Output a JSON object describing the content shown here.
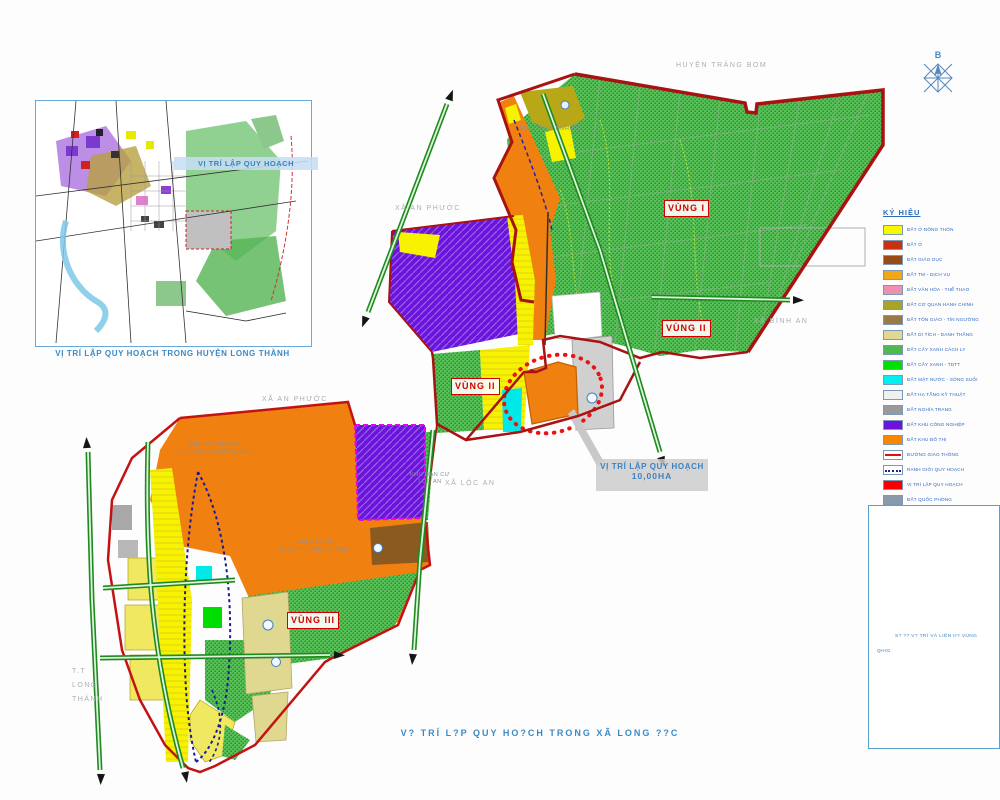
{
  "inset": {
    "title": "VỊ TRÍ LẬP QUY HOẠCH",
    "caption": "VỊ TRÍ LẬP QUY HOẠCH TRONG HUYỆN LONG THÀNH"
  },
  "map": {
    "region_labels": {
      "huyen_trang_bom": "HUYỆN TRẢNG BOM",
      "xa_an_phuoc_top": "XÃ AN PHƯỚC",
      "xa_binh_an": "XÃ BÌNH AN",
      "xa_loc_an": "XÃ LỘC AN",
      "xa_an_phuoc_mid": "XÃ AN PHƯỚC",
      "tt_line1": "T.T",
      "tt_line2": "LONG",
      "tt_line3": "THÀNH"
    },
    "zone_labels": {
      "vung1": "VÙNG I",
      "vung2_east": "VÙNG II",
      "vung2_west": "VÙNG II",
      "vung3": "VÙNG III"
    },
    "site_callout": {
      "line1": "VỊ TRÍ LẬP QUY HOẠCH",
      "line2": "10,00HA"
    },
    "area_texts": {
      "khu_cong_nghiep": "KHU CÔNG NGHIỆP",
      "khu_do_thi_1": "KHU ĐÔ THỊ MỚI",
      "khu_do_thi_2": "(CTY CAO SU ĐỒNG NAI)",
      "kdc_loc_an_1": "KHU DÂN CƯ",
      "kdc_loc_an_2": "LỘC AN",
      "kdc_2_1": "KHU DÂN CƯ",
      "kdc_2_2": "(CTY CP LONG THÀNH)"
    },
    "bottom_caption": "V? TRÍ L?P QUY HO?CH TRONG XÃ LONG ??C",
    "north_label": "B"
  },
  "legend": {
    "header": "KÝ HIỆU",
    "items": [
      {
        "label": "ĐẤT Ở NÔNG THÔN",
        "color": "#f8f800"
      },
      {
        "label": "ĐẤT Ở",
        "color": "#c83010"
      },
      {
        "label": "ĐẤT GIÁO DỤC",
        "color": "#9a4a14"
      },
      {
        "label": "ĐẤT TM - DỊCH VỤ",
        "color": "#f0a818"
      },
      {
        "label": "ĐẤT VĂN HÓA - THỂ THAO",
        "color": "#f090b0"
      },
      {
        "label": "ĐẤT CƠ QUAN HÀNH CHÍNH",
        "color": "#a8a428"
      },
      {
        "label": "ĐẤT TÔN GIÁO - TÍN NGƯỠNG",
        "color": "#9a7848"
      },
      {
        "label": "ĐẤT DI TÍCH - DANH THẮNG",
        "color": "#e0d890"
      },
      {
        "label": "ĐẤT CÂY XANH CÁCH LY",
        "color": "#50b850",
        "type": "dots"
      },
      {
        "label": "ĐẤT CÂY XANH - TDTT",
        "color": "#00e000"
      },
      {
        "label": "ĐẤT MẶT NƯỚC - SÔNG SUỐI",
        "color": "#00f0f0"
      },
      {
        "label": "ĐẤT HẠ TẦNG KỸ THUẬT",
        "color": "#f0f0f0"
      },
      {
        "label": "ĐẤT NGHĨA TRANG",
        "color": "#9a9a9a"
      },
      {
        "label": "ĐẤT KHU CÔNG NGHIỆP",
        "color": "#6a14dc"
      },
      {
        "label": "ĐẤT KHU ĐÔ THỊ",
        "color": "#f88800"
      },
      {
        "label": "ĐƯỜNG GIAO THÔNG",
        "type": "line-red"
      },
      {
        "label": "RANH GIỚI QUY HOẠCH",
        "type": "line-dotted"
      },
      {
        "label": "VỊ TRÍ LẬP QUY HOẠCH",
        "color": "#f80000"
      },
      {
        "label": "ĐẤT QUỐC PHÒNG",
        "color": "#8a98a8"
      }
    ]
  },
  "sheet_box": {
    "line1": "S? ?? V? TRÍ VÀ LIÊN H? VÙNG",
    "line2": "QH-01"
  },
  "colors": {
    "accent_blue": "#3b82c4",
    "boundary_red": "#b01010",
    "road_green": "#2a9a2a",
    "label_gray": "#a8b0b4",
    "zone_label_red": "#d40000"
  }
}
